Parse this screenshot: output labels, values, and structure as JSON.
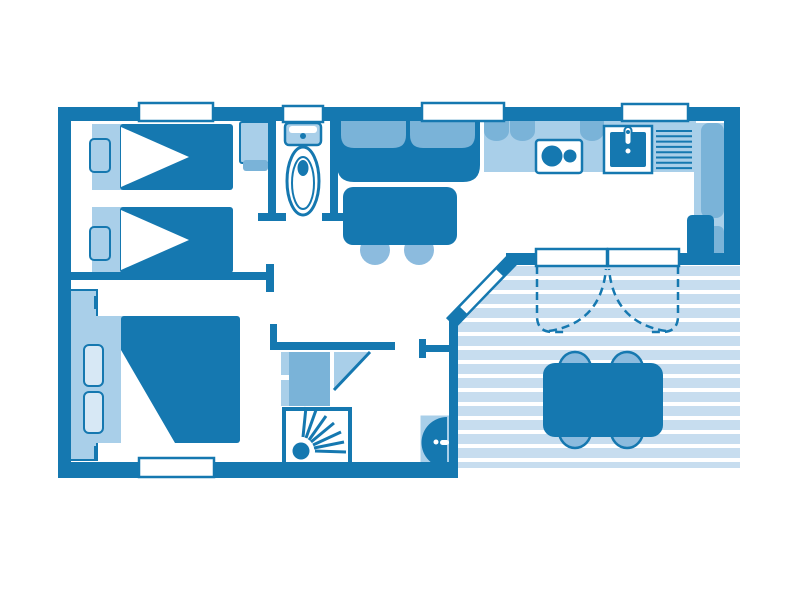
{
  "colors": {
    "primary": "#1578b0",
    "medium": "#7ab3d8",
    "light": "#a9cfe9",
    "deck": "#c7ddef",
    "pillow": "#d7e8f5",
    "stool": "#8cbbde",
    "white": "#ffffff"
  },
  "floorplan": {
    "type": "mobile-home-floor-plan",
    "rooms": [
      {
        "id": "bedroom-1",
        "furniture": [
          "single-bed",
          "single-bed",
          "nightstand",
          "nightstand",
          "wardrobe"
        ]
      },
      {
        "id": "bedroom-2",
        "furniture": [
          "double-bed",
          "pillow",
          "pillow",
          "closet"
        ]
      },
      {
        "id": "bathroom",
        "furniture": [
          "toilet"
        ]
      },
      {
        "id": "shower-room",
        "furniture": [
          "shower",
          "cabinet",
          "corner-shelf"
        ]
      },
      {
        "id": "living-room",
        "furniture": [
          "sofa",
          "coffee-table",
          "stool",
          "stool"
        ]
      },
      {
        "id": "kitchen",
        "furniture": [
          "counter",
          "stove",
          "sink",
          "drainer",
          "fridge-cabinet"
        ]
      },
      {
        "id": "hallway",
        "furniture": [
          "water-heater"
        ]
      },
      {
        "id": "terrace",
        "furniture": [
          "dining-table",
          "chair",
          "chair",
          "chair",
          "chair",
          "curtains"
        ]
      }
    ],
    "openings": [
      "window-bedroom-1",
      "window-bathroom",
      "window-living",
      "window-kitchen",
      "window-bedroom-2",
      "sliding-bay-door",
      "entrance-door"
    ]
  }
}
